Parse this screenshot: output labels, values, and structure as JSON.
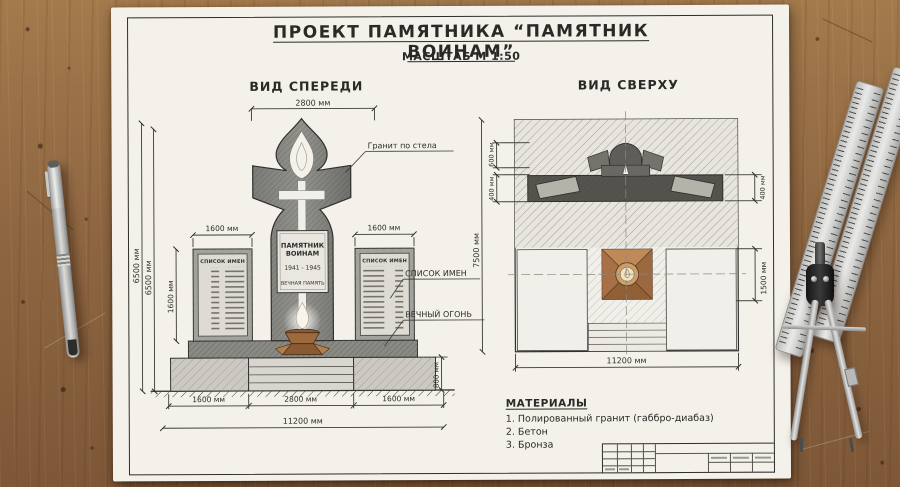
{
  "title": "ПРОЕКТ ПАМЯТНИКА “ПАМЯТНИК ВОИНАМ”",
  "scale": "МАСШТАБ М 1:50",
  "front": {
    "label": "ВИД СПЕРЕДИ",
    "dims": {
      "top_width": "2800 мм",
      "total_height_a": "6500 мм",
      "total_height_b": "6500 мм",
      "stele_height": "1600 мм",
      "stele_width_left": "1600 мм",
      "stele_width_right": "1600 мм",
      "base_height": "800 мм",
      "bottom_left": "1600 мм",
      "bottom_center": "2800 мм",
      "bottom_right": "1600 мм",
      "total_width": "11200 мм"
    },
    "plaque": {
      "line1": "ПАМЯТНИК",
      "line2": "ВОИНАМ",
      "years": "1941 - 1945",
      "memory": "ВЕЧНАЯ ПАМЯТЬ"
    },
    "panel_header_left": "СПИСОК ИМЕН",
    "panel_header_right": "СПИСОК ИМЕН",
    "callouts": {
      "granite": "Гранит по стела",
      "names": "СПИСОК ИМЕН",
      "flame": "ВЕЧНЫЙ ОГОНЬ"
    }
  },
  "top": {
    "label": "ВИД СВЕРХУ",
    "dims": {
      "height": "7500 мм",
      "d600": "600 мм",
      "d400_left": "400 мм",
      "d400_right": "400 мм",
      "d1500": "1500 мм",
      "width": "11200 мм"
    }
  },
  "materials": {
    "header": "МАТЕРИАЛЫ",
    "items": [
      "1. Полированный гранит (габбро-диабаз)",
      "2. Бетон",
      "3. Бронза"
    ]
  },
  "colors": {
    "paper": "#f3f1ea",
    "ink": "#2e2d2b",
    "granite_dark": "#6f6f6d",
    "granite_light": "#a3a39e",
    "bronze": "#b07c4e",
    "wood": "#8f6742"
  }
}
